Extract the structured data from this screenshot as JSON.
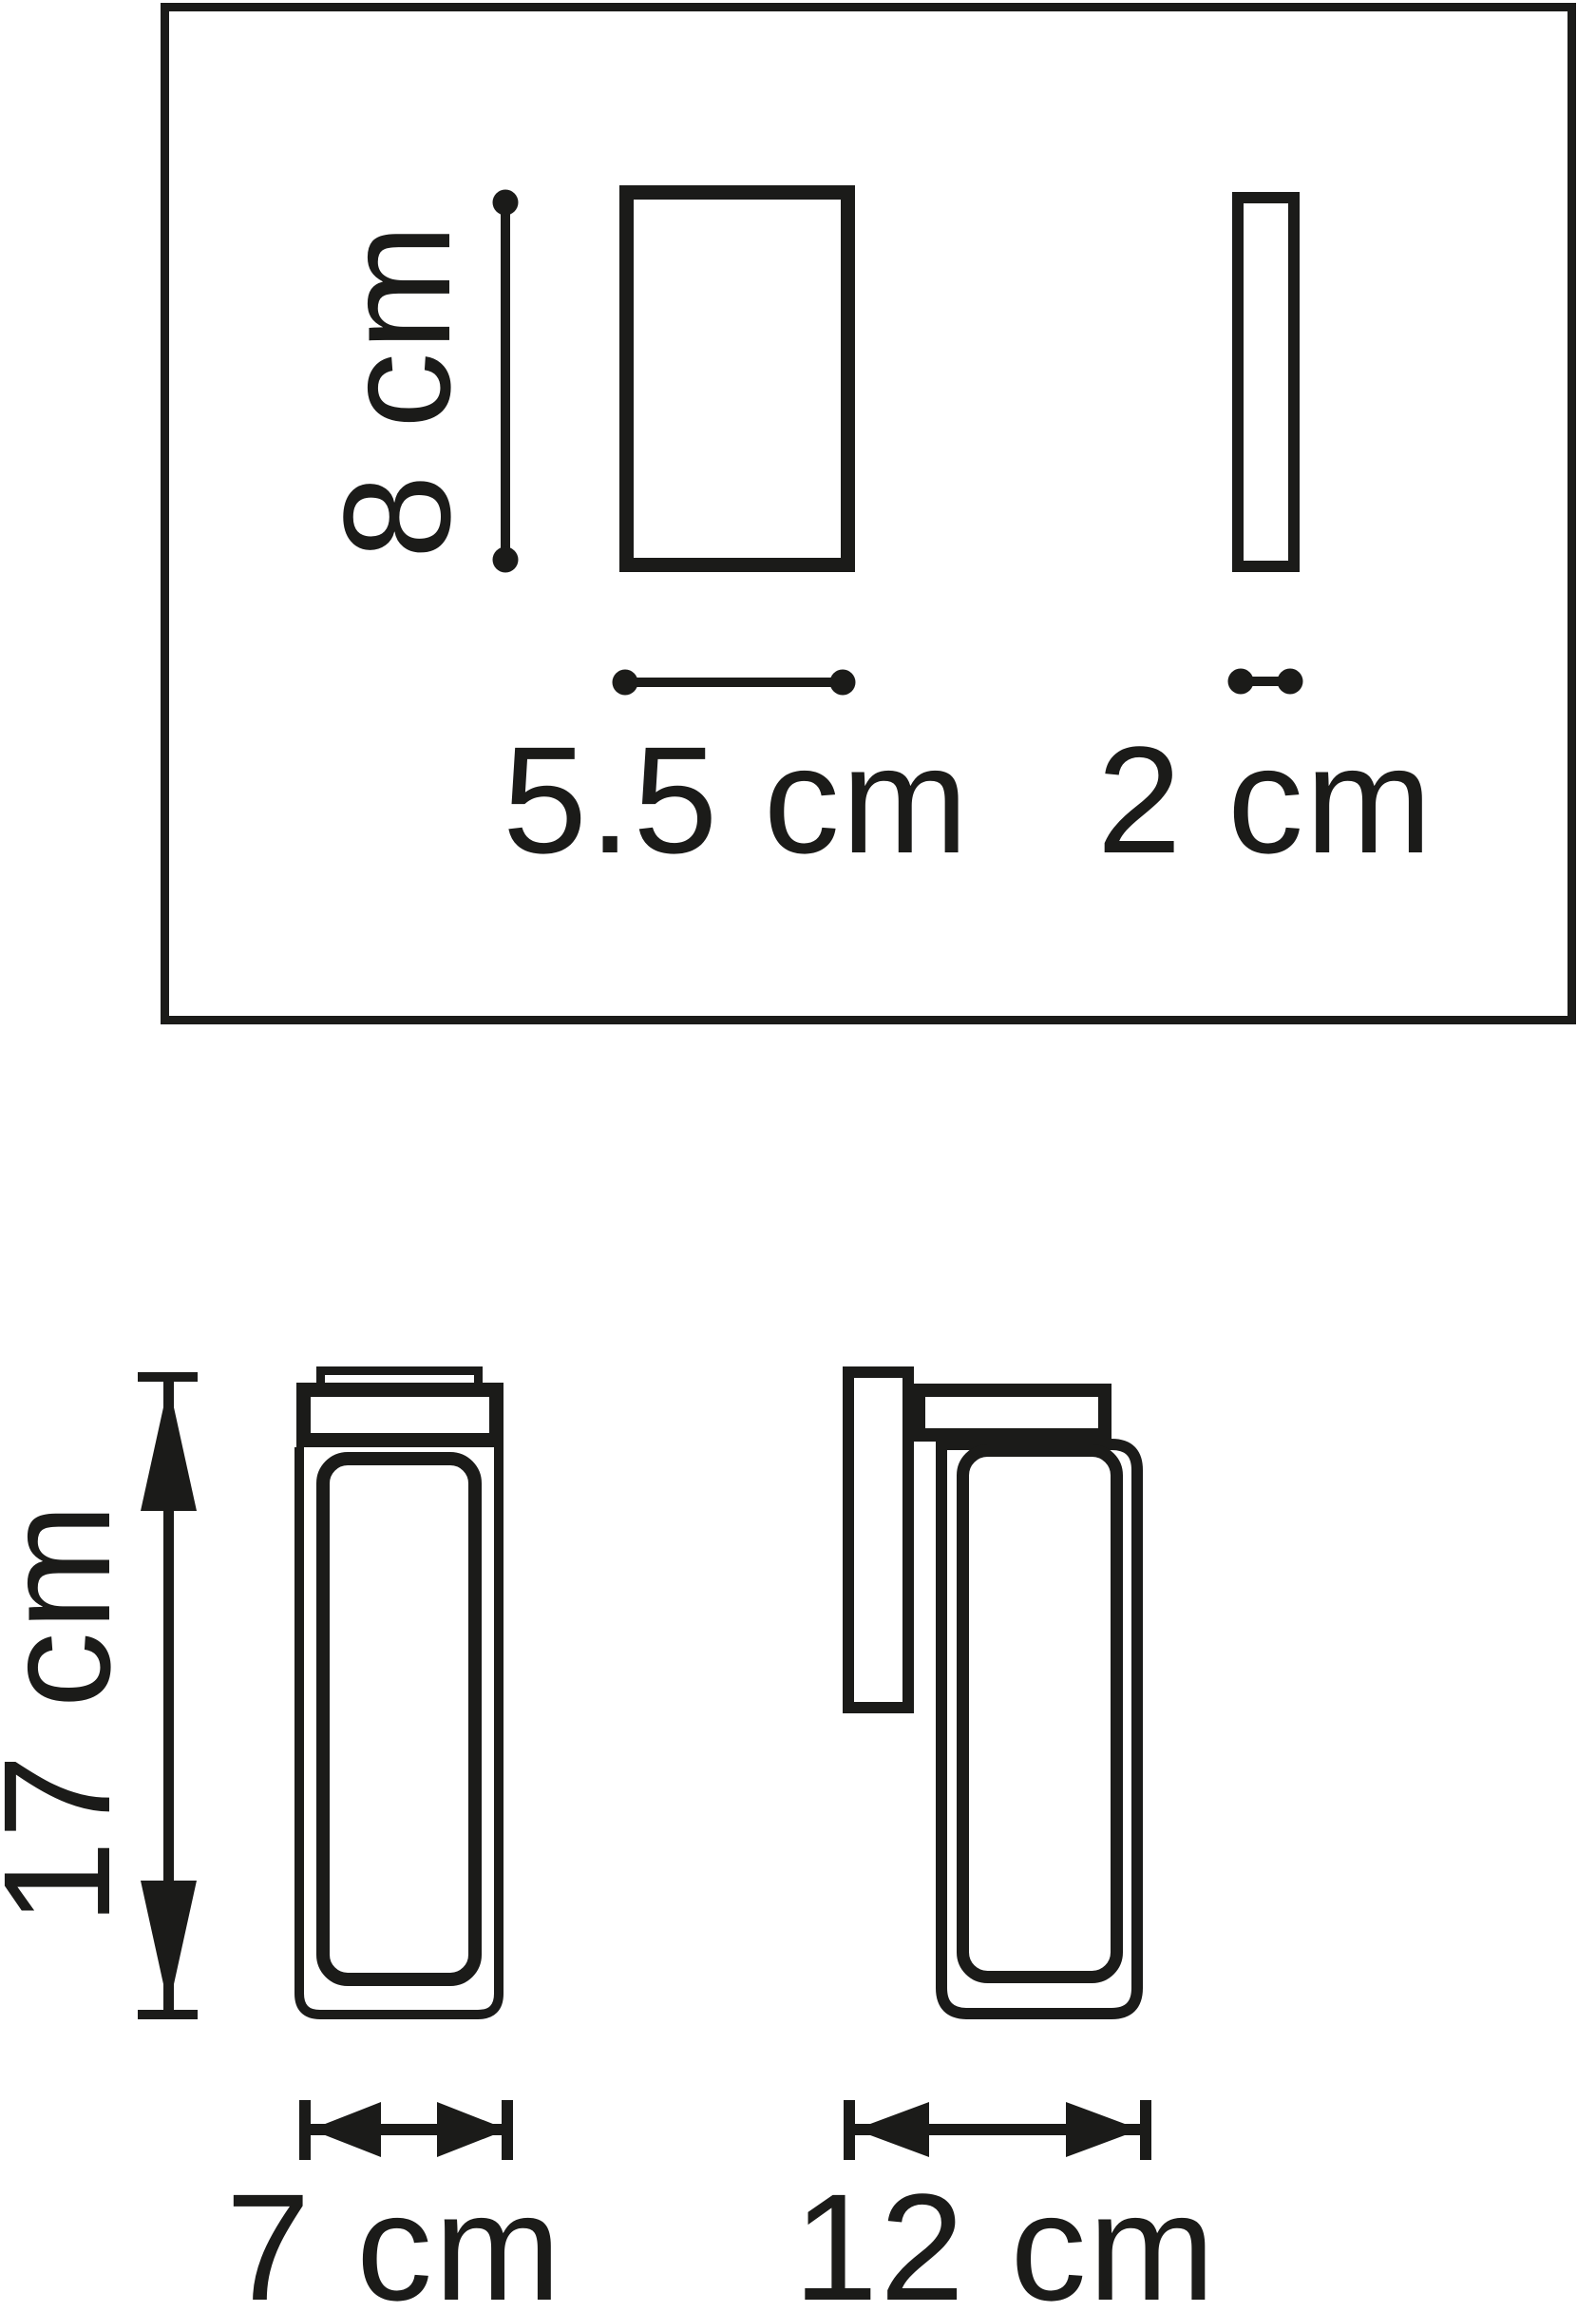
{
  "colors": {
    "ink": "#1b1b19",
    "background": "#ffffff"
  },
  "spec_panel": {
    "height": {
      "label": "8 cm",
      "value": 8,
      "unit": "cm"
    },
    "width": {
      "label": "5.5 cm",
      "value": 5.5,
      "unit": "cm"
    },
    "depth": {
      "label": "2 cm",
      "value": 2,
      "unit": "cm"
    }
  },
  "drawing": {
    "height": {
      "label": "17 cm",
      "value": 17,
      "unit": "cm"
    },
    "front_width": {
      "label": "7 cm",
      "value": 7,
      "unit": "cm"
    },
    "side_depth": {
      "label": "12 cm",
      "value": 12,
      "unit": "cm"
    }
  }
}
